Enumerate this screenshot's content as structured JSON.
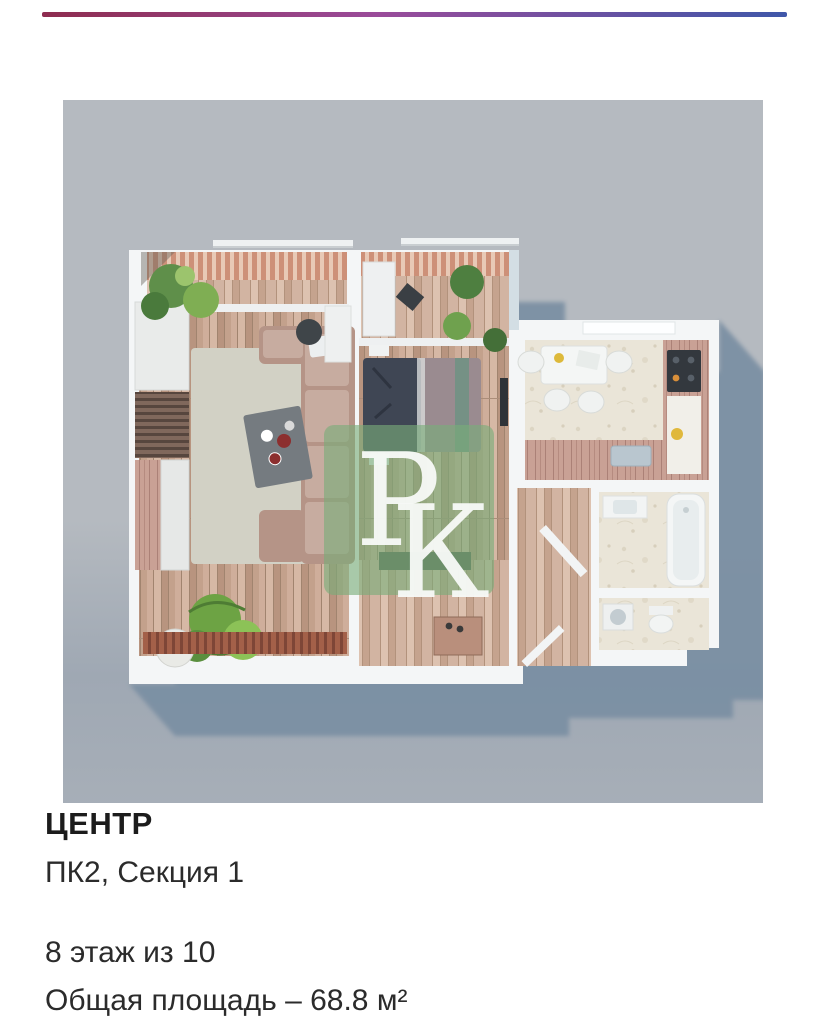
{
  "listing": {
    "complex_name": "ЦЕНТР",
    "section": "ПК2, Секция 1",
    "floor": "8 этаж из 10",
    "area": "Общая площадь – 68.8 м²"
  },
  "floor_plan": {
    "watermark_letters": [
      "Р",
      "К"
    ]
  },
  "colors": {
    "page_bg": "#ffffff",
    "accent_left": "#8e2c4f",
    "accent_mid": "#9a4b9a",
    "accent_right": "#3f57a9",
    "plan_bg": "#b5bac0",
    "shadow": "#7a8fa3",
    "watermark_green": "#79ad79",
    "text": "#222222"
  }
}
